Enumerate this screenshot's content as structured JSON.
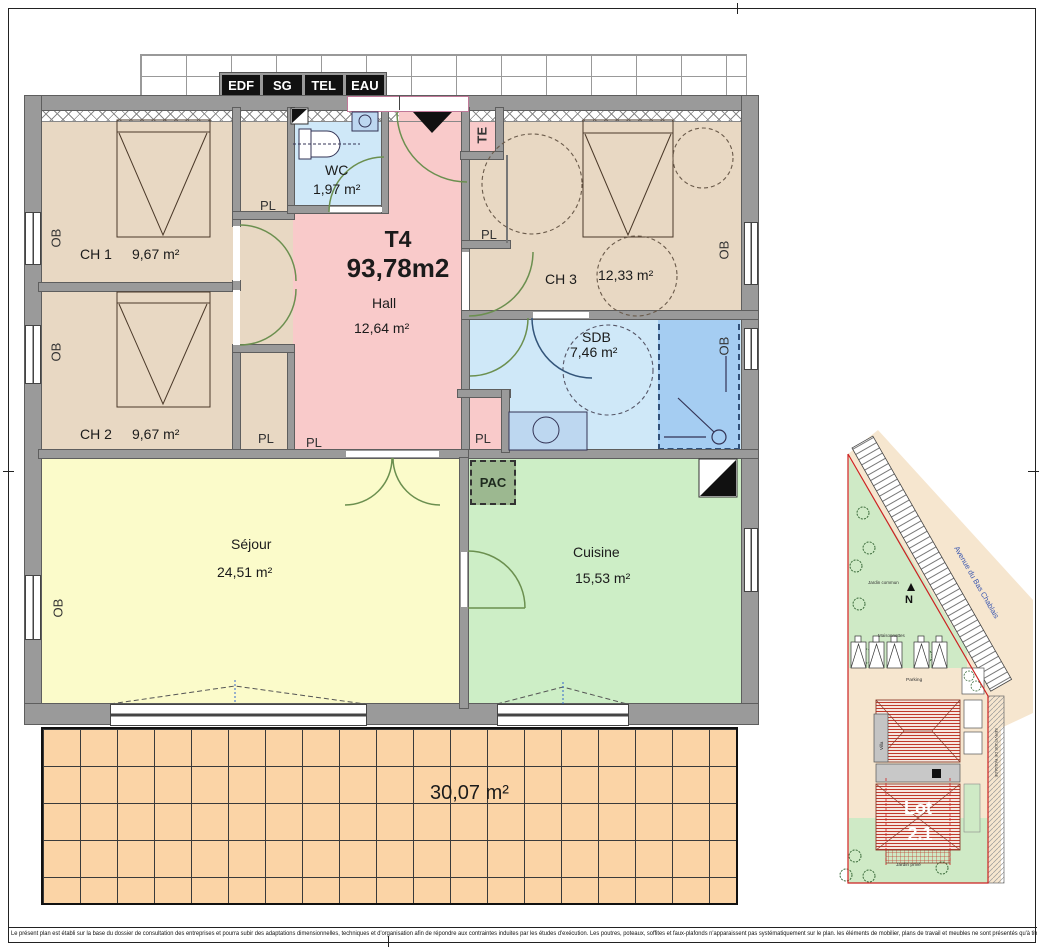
{
  "apartment": {
    "type": "T4",
    "total_area": "93,78m2"
  },
  "utility_box": {
    "labels": [
      "EDF",
      "SG",
      "TEL",
      "EAU"
    ]
  },
  "rooms": {
    "ch1": {
      "name": "CH 1",
      "area": "9,67 m²"
    },
    "ch2": {
      "name": "CH 2",
      "area": "9,67 m²"
    },
    "ch3": {
      "name": "CH 3",
      "area": "12,33 m²"
    },
    "wc": {
      "name": "WC",
      "area": "1,97 m²"
    },
    "hall": {
      "name": "Hall",
      "area": "12,64 m²"
    },
    "sdb": {
      "name": "SDB",
      "area": "7,46 m²"
    },
    "sejour": {
      "name": "Séjour",
      "area": "24,51 m²"
    },
    "cuisine": {
      "name": "Cuisine",
      "area": "15,53 m²"
    },
    "terrace": {
      "area": "30,07 m²"
    }
  },
  "tags": {
    "pl": "PL",
    "ob": "OB",
    "te": "TE",
    "pac": "PAC"
  },
  "site_plan": {
    "street": "Avenue du Bas Chablais",
    "north": "N",
    "jardin_commun": "Jardin commun",
    "maisonnettes": "Maisonnettes",
    "parking": "Parking",
    "villa": "Villa",
    "lot_name": "Lot",
    "lot_number": "2.1",
    "jardin_prive": "Jardin privé",
    "servitude": "SERVITUDE DE PASSAGE"
  },
  "footer": {
    "disclaimer": "Le présent plan est établi sur la base du dossier de consultation des entreprises et pourra subir des adaptations dimensionnelles, techniques et d'organisation afin de répondre aux contraintes induites par les études d'exécution. Les poutres, poteaux, soffites et faux-plafonds n'apparaissent pas systématiquement sur le plan. les éléments de mobilier, plans de travail et meubles ne sont présentés qu'à titre indicatif."
  },
  "colors": {
    "bedroom": "#e8d8c3",
    "hall": "#f9caca",
    "water": "#cfe8f8",
    "shower": "#a5cdf2",
    "living": "#fbfbca",
    "kitchen": "#cdeec6",
    "pac": "#9cb890",
    "terrace": "#fbd4a6",
    "wall": "#9a9a9a",
    "door_arc": "#6b8f4f",
    "site_green": "#cfeac6",
    "site_beige": "#f6e6cf",
    "lot_red": "#cc2222",
    "street_blue": "#3a57b0"
  }
}
